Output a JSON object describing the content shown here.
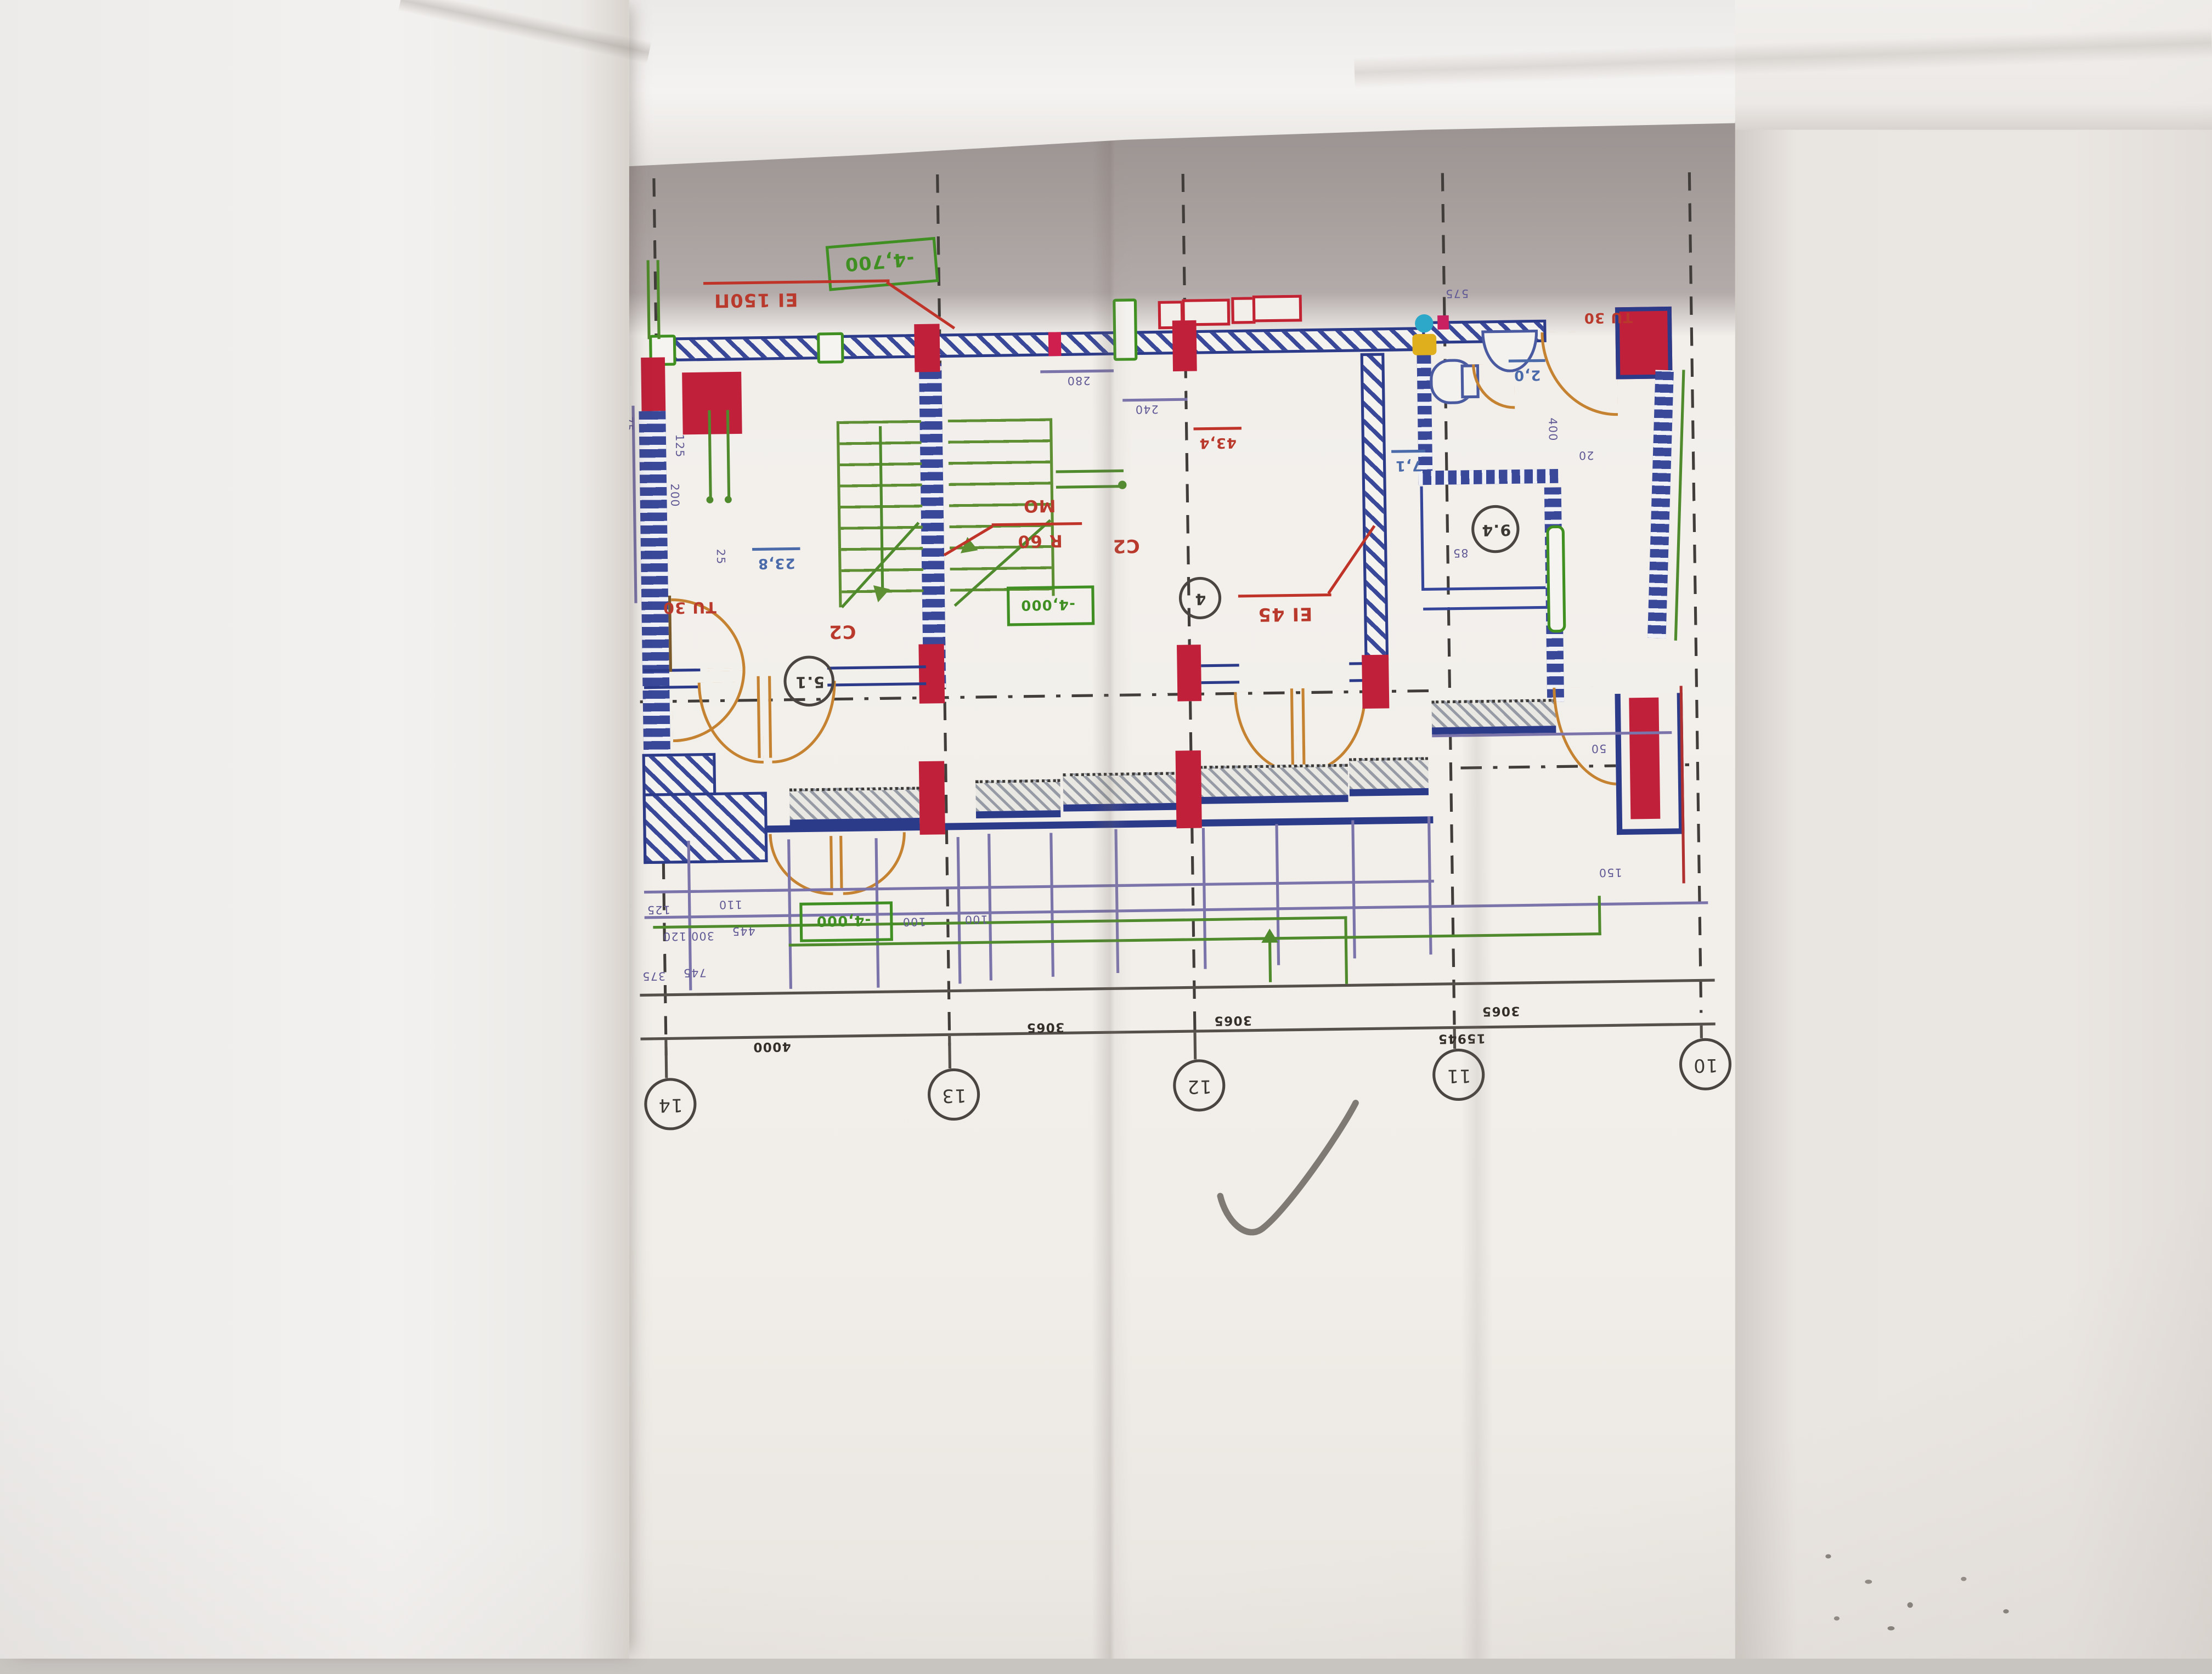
{
  "plan": {
    "levels": {
      "top": "-4,700",
      "middle": "-4,000",
      "bottom": "-4,000"
    },
    "fire": {
      "top_wall": "EI 150П",
      "partition": "EI 45"
    },
    "doors": {
      "left": "TU 30",
      "top_right": "TU 30"
    },
    "stair": {
      "top": "MO",
      "bottom": "R 60"
    },
    "rooms": {
      "left": {
        "type": "C2",
        "area": "23,8",
        "number": "5.1"
      },
      "right": {
        "type": "C2",
        "area": "43,4",
        "number": "4"
      },
      "small": {
        "number": "9.4"
      },
      "bath": {
        "area": "2,0"
      },
      "aux": {
        "area": "7,1"
      }
    },
    "grid": {
      "bubbles": [
        "14",
        "13",
        "12",
        "11",
        "10"
      ],
      "spans": [
        "4000",
        "3065",
        "3065",
        "3065"
      ],
      "total": "15945"
    },
    "dims": {
      "top": [
        "280",
        "240",
        "575"
      ],
      "left": [
        "75",
        "125",
        "200",
        "25"
      ],
      "bottom_left": [
        "125",
        "110",
        "300 120",
        "445",
        "375",
        "745"
      ],
      "bottom_mid": [
        "100",
        "100"
      ],
      "right": [
        "400",
        "20",
        "85",
        "50",
        "150"
      ]
    }
  }
}
